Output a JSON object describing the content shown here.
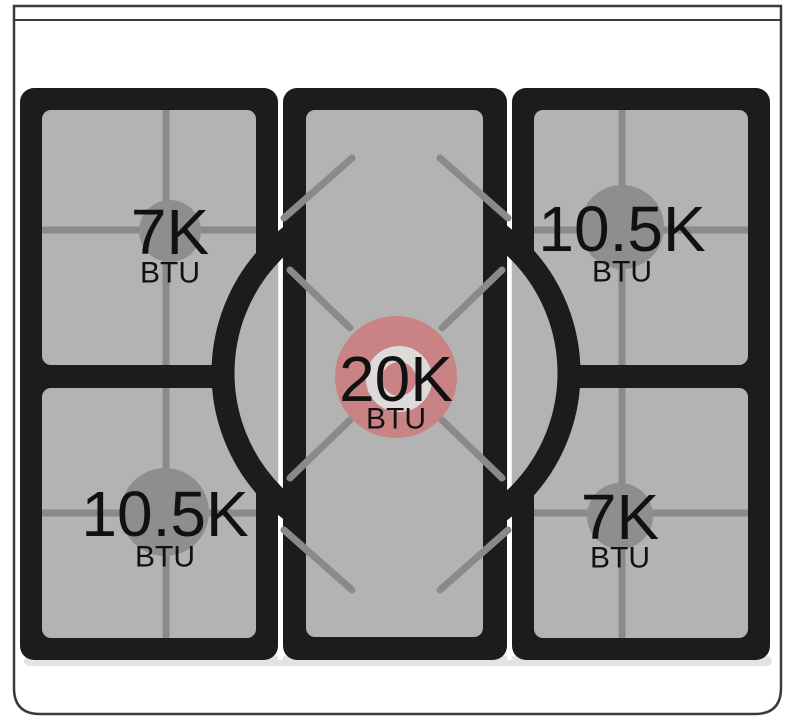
{
  "colors": {
    "cooktop-black": "#1c1c1c",
    "surface-gray": "#b3b3b3",
    "line-gray": "#8a8a8a",
    "burner-gray": "#8e8e8e",
    "burner-red": "#c98384",
    "ring-white": "#dedada",
    "text-black": "#111111",
    "body-white": "#ffffff",
    "outline": "#3a3a3a",
    "shadow-gray": "#d9d9d9"
  },
  "burners": {
    "top_left": {
      "btu": "7K",
      "unit": "BTU"
    },
    "top_right": {
      "btu": "10.5K",
      "unit": "BTU"
    },
    "center": {
      "btu": "20K",
      "unit": "BTU"
    },
    "bottom_left": {
      "btu": "10.5K",
      "unit": "BTU"
    },
    "bottom_right": {
      "btu": "7K",
      "unit": "BTU"
    }
  }
}
